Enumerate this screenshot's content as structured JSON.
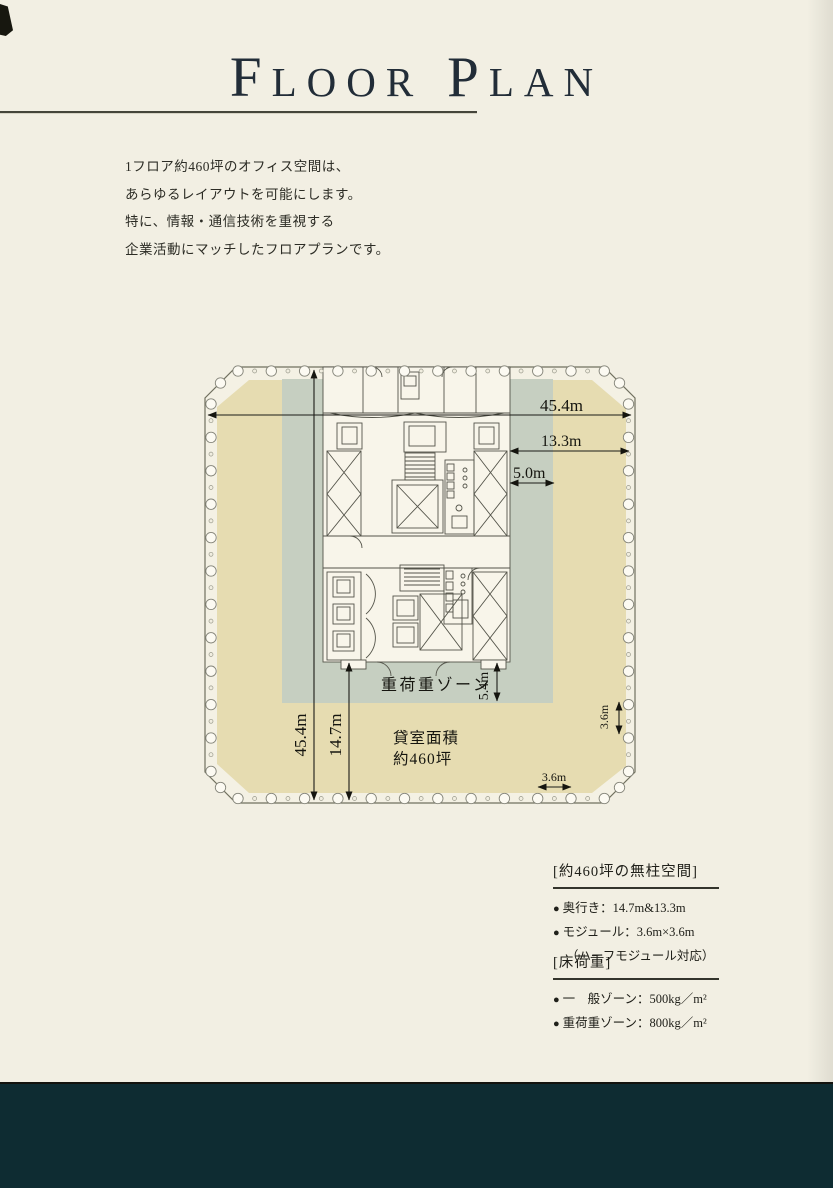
{
  "title": {
    "initial1": "F",
    "word1": "LOOR",
    "initial2": "P",
    "word2": "LAN"
  },
  "intro": {
    "lines": [
      "1フロア約460坪のオフィス空間は、",
      "あらゆるレイアウトを可能にします。",
      "特に、情報・通信技術を重視する",
      "企業活動にマッチしたフロアプランです。"
    ]
  },
  "plan": {
    "dims": {
      "width_top": "45.4m",
      "depth_right": "13.3m",
      "core_depth": "5.0m",
      "height_left": "45.4m",
      "depth_bottom": "14.7m",
      "heavy_zone_depth": "5.4m",
      "module_v": "3.6m",
      "module_h": "3.6m"
    },
    "labels": {
      "heavy_zone": "重荷重ゾーン",
      "rent_area_1": "貸室面積",
      "rent_area_2": "約460坪"
    },
    "colors": {
      "floor_tan": "#e6dcb1",
      "heavy_zone_green": "#c6cfc1",
      "core_white": "#f8f5ea",
      "outline": "#70705f"
    }
  },
  "specs": {
    "columnless": {
      "header": "[約460坪の無柱空間]",
      "items": [
        {
          "text": "奥行き：14.7m&13.3m"
        },
        {
          "text": "モジュール：3.6m×3.6m"
        },
        {
          "text": "（ハーフモジュール対応）"
        }
      ]
    },
    "floor_load": {
      "header": "[床荷重]",
      "items": [
        {
          "text": "一　般ゾーン：500kg／m²"
        },
        {
          "text": "重荷重ゾーン：800kg／m²"
        }
      ]
    }
  },
  "glyphs": {
    "bullet": "●"
  },
  "page_colors": {
    "background": "#f2efe3",
    "bottom_band": "#0e2c32"
  }
}
